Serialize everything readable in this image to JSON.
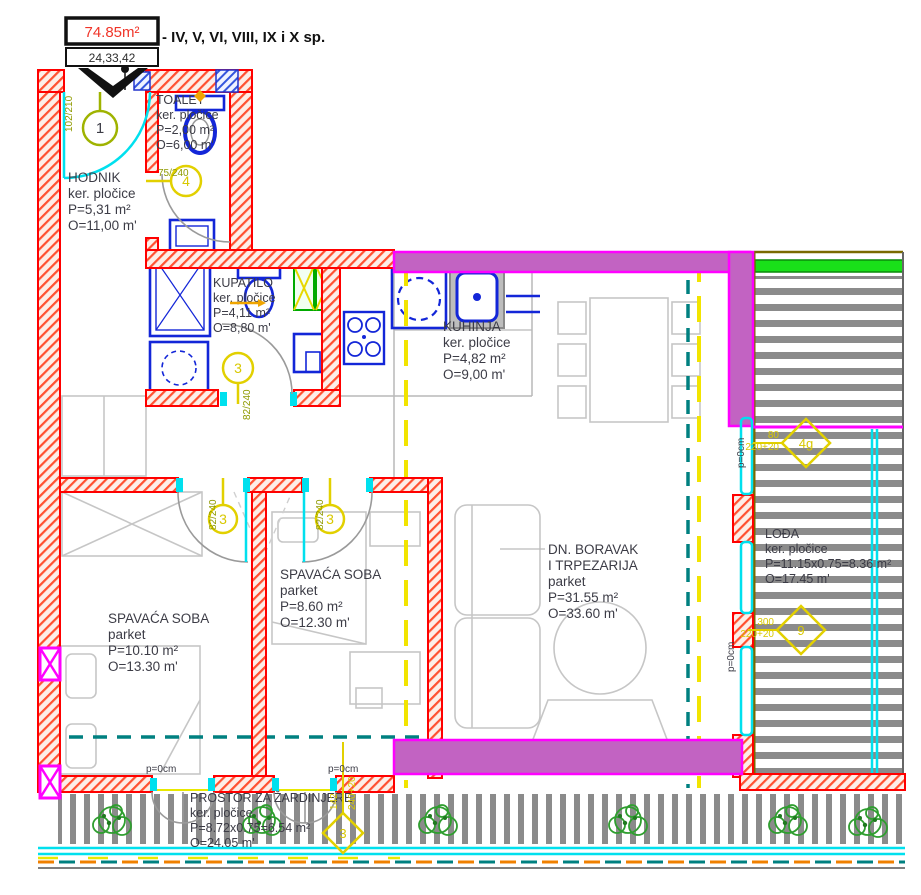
{
  "header": {
    "area": "74.85m²",
    "units": "24,33,42",
    "floors": "- IV, V, VI, VIII, IX i X sp."
  },
  "rooms": {
    "hodnik": {
      "name": "HODNIK",
      "floor": "ker. pločice",
      "area": "P=5,31 m²",
      "perimeter": "O=11,00 m'"
    },
    "toalet": {
      "name": "TOALET",
      "floor": "ker. pločice",
      "area": "P=2,00 m²",
      "perimeter": "O=6,00 m'"
    },
    "kupatilo": {
      "name": "KUPATILO",
      "floor": "ker. pločice",
      "area": "P=4,11 m²",
      "perimeter": "O=8,80 m'"
    },
    "kuhinja": {
      "name": "KUHINJA",
      "floor": "ker. pločice",
      "area": "P=4,82 m²",
      "perimeter": "O=9,00 m'"
    },
    "spavaca_lijeva": {
      "name": "SPAVAĆA SOBA",
      "floor": "parket",
      "area": "P=10.10 m²",
      "perimeter": "O=13.30 m'"
    },
    "spavaca_srednja": {
      "name": "SPAVAĆA SOBA",
      "floor": "parket",
      "area": "P=8.60 m²",
      "perimeter": "O=12.30 m'"
    },
    "boravak": {
      "name_line1": "DN. BORAVAK",
      "name_line2": "I TRPEZARIJA",
      "floor": "parket",
      "area": "P=31.55 m²",
      "perimeter": "O=33.60 m'"
    },
    "loda": {
      "name": "LOĐA",
      "floor": "ker. pločice",
      "area": "P=11.15x0.75=8.36 m²",
      "perimeter": "O=17.45 m'"
    },
    "zardinjere": {
      "name": "PROSTOR ZA ŽARDINJERE",
      "floor": "ker. pločice",
      "area": "P=8.72x0.75=6.54 m²",
      "perimeter": "O=24.05 m'"
    }
  },
  "door_tags": {
    "entrance": {
      "number": "1",
      "dim": "102/210"
    },
    "toalet": {
      "number": "4",
      "dim": "75/240"
    },
    "kupatilo": {
      "number": "3",
      "dim": "82/240"
    },
    "spavaca_lijeva": {
      "number": "3",
      "dim": "82/240"
    },
    "spavaca_srednja": {
      "number": "3",
      "dim": "82/240"
    }
  },
  "window_tags": {
    "w1": {
      "number": "4g",
      "width": "80",
      "height": "220+20"
    },
    "w2": {
      "number": "9",
      "width": "300",
      "height": "220+20"
    },
    "w3": {
      "number": "3",
      "width": "142",
      "height": "240+20"
    }
  },
  "annotations": {
    "parapet": "p=0cm"
  },
  "colors": {
    "wall_red": "#ff0000",
    "wall_magenta": "#ff00ff",
    "wall_fill_purple": "#c263c2",
    "glazing_cyan": "#00e0ee",
    "section_yellow": "#f2e400",
    "axis_teal": "#008080",
    "fixture_blue": "#1326d8",
    "tag_olive": "#8f9a00",
    "plant_green": "#2f9e2f",
    "deck_gray": "#8b8b8b",
    "header_area_red": "#f03428"
  }
}
